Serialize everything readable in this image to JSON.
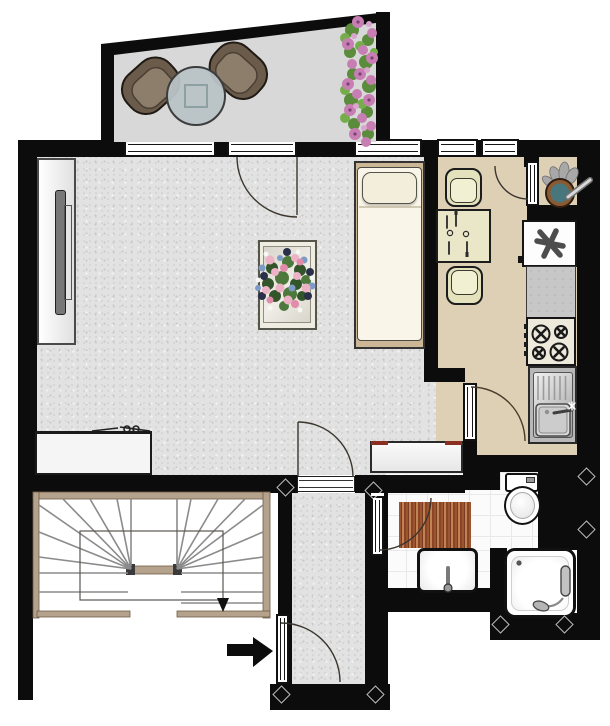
{
  "page": {
    "title": "Apartment floor plan"
  },
  "legend": {
    "entry_arrow_direction": "right",
    "stair_arrow_direction": "down"
  },
  "rooms": [
    {
      "id": "balcony",
      "label": "Balcony",
      "items": [
        "lounge chair",
        "lounge chair",
        "round glass table",
        "flower boxes"
      ]
    },
    {
      "id": "living-room",
      "label": "Living room",
      "items": [
        "wardrobe",
        "single bed",
        "table with flower bouquet",
        "sideboard",
        "lowboard"
      ]
    },
    {
      "id": "kitchen",
      "label": "Kitchen",
      "items": [
        "dining table with two place settings",
        "chair",
        "chair",
        "freezer",
        "worktop",
        "cooktop with four burners",
        "sink with drainer",
        "decorative bowl"
      ]
    },
    {
      "id": "hallway",
      "label": "Hallway",
      "items": [
        "entrance door"
      ]
    },
    {
      "id": "bathroom",
      "label": "Bathroom",
      "items": [
        "toilet",
        "washbasin",
        "shower",
        "bath mat"
      ]
    },
    {
      "id": "stairwell",
      "label": "Stairwell",
      "items": [
        "winder staircase"
      ]
    }
  ],
  "colors": {
    "wall": "#0c0c0c",
    "living_floor": "#e2e2e2",
    "kitchen_floor": "#ddd0b5",
    "balcony_floor": "#d8d8d8",
    "tile_floor": "#fbfbfb",
    "stair_wood": "#b4a28c",
    "bath_mat": "#9c5530",
    "flower_pink": "#c77fb3",
    "sideboard_accent_red": "#8c2f23",
    "bed_linen": "#f9f5e8",
    "chair_brown": "#6b5b4b"
  }
}
